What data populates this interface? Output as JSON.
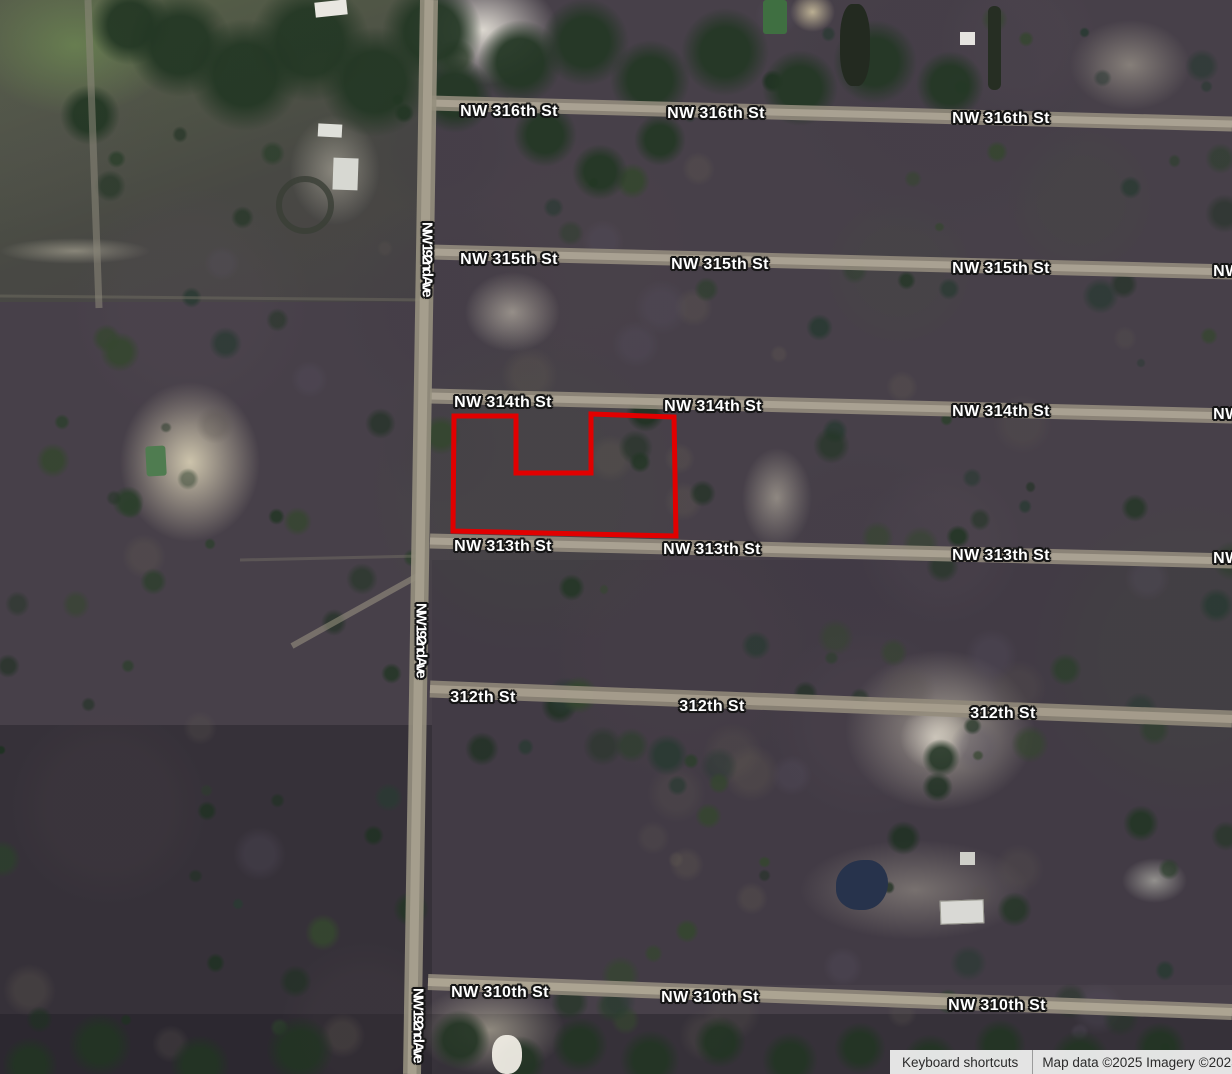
{
  "map": {
    "streets_horizontal": [
      {
        "name": "NW 316th St",
        "labels": [
          {
            "x": 509,
            "y": 112
          },
          {
            "x": 716,
            "y": 114
          },
          {
            "x": 1001,
            "y": 119
          }
        ]
      },
      {
        "name": "NW 315th St",
        "labels": [
          {
            "x": 509,
            "y": 260
          },
          {
            "x": 720,
            "y": 265
          },
          {
            "x": 1001,
            "y": 269
          },
          {
            "x": 1262,
            "y": 272
          }
        ]
      },
      {
        "name": "NW 314th St",
        "labels": [
          {
            "x": 503,
            "y": 403
          },
          {
            "x": 713,
            "y": 407
          },
          {
            "x": 1001,
            "y": 412
          },
          {
            "x": 1262,
            "y": 415
          }
        ]
      },
      {
        "name": "NW 313th St",
        "labels": [
          {
            "x": 503,
            "y": 547
          },
          {
            "x": 712,
            "y": 550
          },
          {
            "x": 1001,
            "y": 556
          },
          {
            "x": 1262,
            "y": 559
          }
        ]
      },
      {
        "name": "312th St",
        "labels": [
          {
            "x": 483,
            "y": 698
          },
          {
            "x": 712,
            "y": 707
          },
          {
            "x": 1003,
            "y": 714
          }
        ]
      },
      {
        "name": "NW 310th St",
        "labels": [
          {
            "x": 500,
            "y": 993
          },
          {
            "x": 710,
            "y": 998
          },
          {
            "x": 997,
            "y": 1006
          }
        ]
      }
    ],
    "streets_vertical": [
      {
        "name": "NW 192nd Ave",
        "labels": [
          {
            "x": 427,
            "y": 222
          },
          {
            "x": 421,
            "y": 603
          },
          {
            "x": 418,
            "y": 988
          }
        ]
      }
    ],
    "parcel": {
      "color": "#e10000",
      "stroke_width": 5,
      "points": [
        [
          454,
          416
        ],
        [
          516,
          416
        ],
        [
          516,
          473
        ],
        [
          591,
          473
        ],
        [
          591,
          414
        ],
        [
          674,
          417
        ],
        [
          676,
          536
        ],
        [
          453,
          531
        ]
      ]
    },
    "attribution": {
      "keyboard_shortcuts": "Keyboard shortcuts",
      "map_data": "Map data ©2025",
      "imagery": "Imagery ©2025"
    }
  }
}
